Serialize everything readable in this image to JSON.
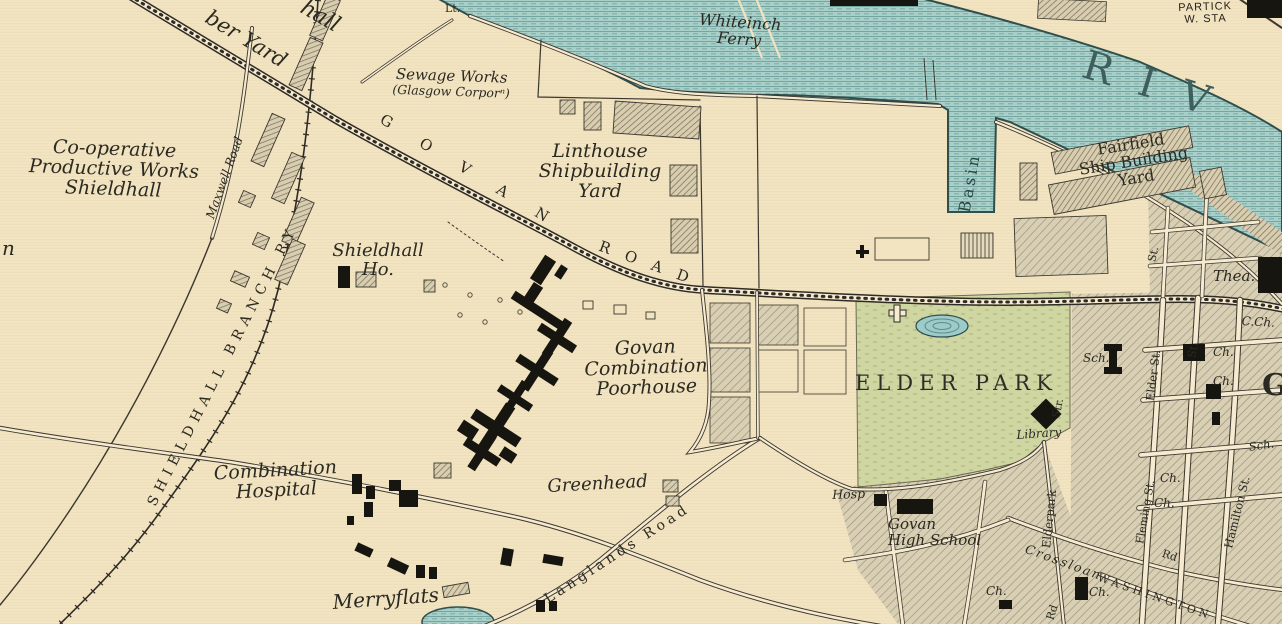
{
  "map_type": "historical-town-plan",
  "colors": {
    "paper": "#f2e3c1",
    "water": "#a9cfc9",
    "water_line": "#74a6a1",
    "bank_ink": "#2f4f4d",
    "park_green": "#cfd6a2",
    "block_fill": "#d9cfb4",
    "hatch_line": "#9a9176",
    "ink": "#2b2a22",
    "building_black": "#17150f",
    "road_fill": "#f6ead0"
  },
  "labels": {
    "top_partial_hall": "hall",
    "top_partial_yard": "ber Yard",
    "lt": "Lt.",
    "whiteinch_ferry": [
      "Whiteinch",
      "Ferry"
    ],
    "partick_sta": [
      "PARTICK",
      "W. STA"
    ],
    "river": "RIV",
    "sewage_works": [
      "Sewage Works",
      "(Glasgow Corporⁿ)"
    ],
    "linthouse": [
      "Linthouse",
      "Shipbuilding",
      "Yard"
    ],
    "govan_road_word1": "GOVAN",
    "govan_road_word2": "ROAD",
    "cooperative": [
      "Co-operative",
      "Productive Works",
      "Shieldhall"
    ],
    "maxwell_road": "Maxwell Road",
    "left_partial_n": "n",
    "shieldhall_branch_ry": "SHIELDHALL BRANCH RY",
    "shieldhall_ho": [
      "Shieldhall",
      "Ho."
    ],
    "poorhouse": [
      "Govan",
      "Combination",
      "Poorhouse"
    ],
    "combination_hospital": [
      "Combination",
      "Hospital"
    ],
    "merryflats": "Merryflats",
    "greenhead": "Greenhead",
    "langlands_road": "Langlands Road",
    "elder_park": "ELDER PARK",
    "library": "Library",
    "sch": "Sch.",
    "hosp": "Hosp",
    "govan_high_school": [
      "Govan",
      "High School"
    ],
    "basin": "Basin",
    "fairfield": [
      "Fairfield",
      "Ship Building",
      "Yard"
    ],
    "thea": "Thea.",
    "c_ch": "C.Ch.",
    "ch": "Ch.",
    "elder_st": "Elder St.",
    "st": "St.",
    "str": "Str.",
    "elderpark": "Elderpark",
    "crossloan": "Crossloan",
    "rd": "Rd",
    "washington": "WASHINGTON",
    "hamilton_st": "Hamilton St.",
    "fleming_st": "Fleming St.",
    "govan_initial": "G"
  }
}
